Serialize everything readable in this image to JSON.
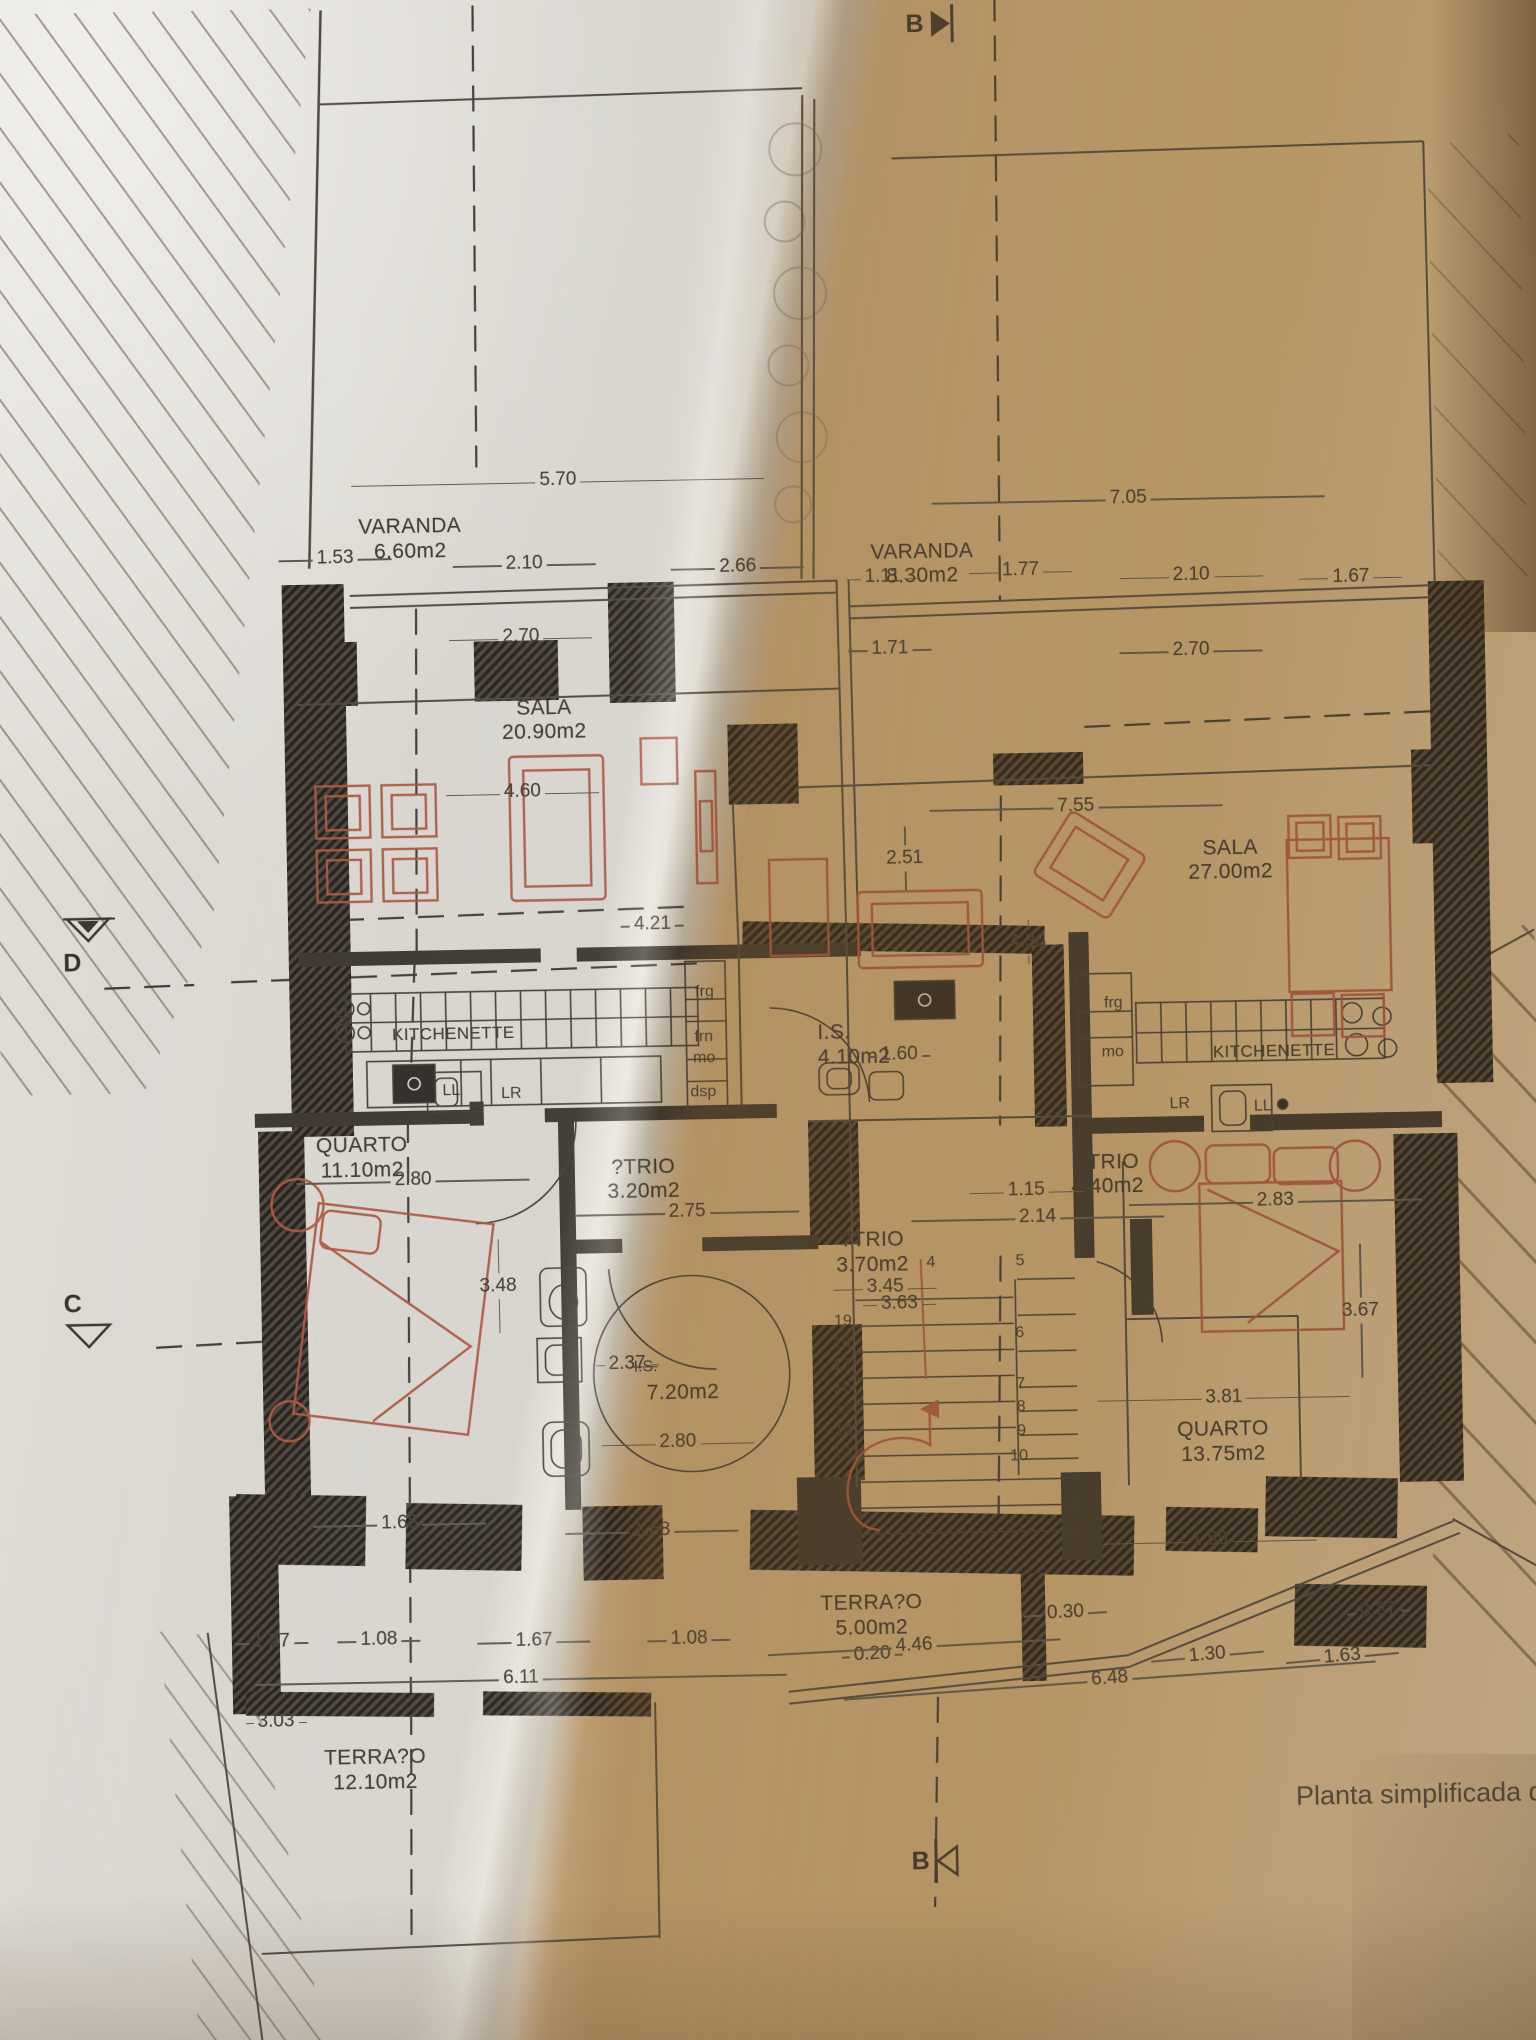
{
  "caption": "Planta simplificada de",
  "markers": {
    "b_top": "B",
    "b_bottom": "B",
    "c": "C",
    "d": "D"
  },
  "colors": {
    "paper_light": "#d9d5ce",
    "paper_shadow": "#c7a778",
    "ink": "#44403a",
    "wall": "#39342d",
    "furniture_red": "#a8553f",
    "dim_text": "#3f3a33"
  },
  "rooms": [
    {
      "id": "varanda-left",
      "name": "VARANDA",
      "area": "6.60m2",
      "x": 27.3,
      "y": 24.9
    },
    {
      "id": "varanda-right",
      "name": "VARANDA",
      "area": "8.30m2",
      "x": 60.6,
      "y": 26.6
    },
    {
      "id": "sala-left",
      "name": "SALA",
      "area": "20.90m2",
      "x": 35.8,
      "y": 33.9
    },
    {
      "id": "sala-right",
      "name": "SALA",
      "area": "27.00m2",
      "x": 80.3,
      "y": 41.4
    },
    {
      "id": "quarto-left",
      "name": "QUARTO",
      "area": "11.10m2",
      "x": 23.4,
      "y": 55.2
    },
    {
      "id": "quarto-right",
      "name": "QUARTO",
      "area": "13.75m2",
      "x": 79.1,
      "y": 69.9
    },
    {
      "id": "kitchenette-left",
      "name": "KITCHENETTE",
      "area": "",
      "x": 29.5,
      "y": 49.9,
      "small": true
    },
    {
      "id": "kitchenette-right",
      "name": "KITCHENETTE",
      "area": "",
      "x": 82.9,
      "y": 51.5,
      "small": true
    },
    {
      "id": "is-small",
      "name": "I.S.",
      "area": "4.10m2",
      "x": 53.2,
      "y": 50.1,
      "anchor": "left"
    },
    {
      "id": "atrio-left",
      "name": "?TRIO",
      "area": "3.20m2",
      "x": 41.7,
      "y": 56.5
    },
    {
      "id": "atrio-right",
      "name": "?TRIO",
      "area": "4.40m2",
      "x": 71.9,
      "y": 56.7
    },
    {
      "id": "atrio-mid",
      "name": "?TRIO",
      "area": "3.70m2",
      "x": 56.5,
      "y": 60.3
    },
    {
      "id": "is-big",
      "name": "",
      "area": "7.20m2",
      "x": 44.0,
      "y": 67.6
    },
    {
      "id": "terraco-small",
      "name": "TERRA?O",
      "area": "5.00m2",
      "x": 56.0,
      "y": 78.1
    },
    {
      "id": "terraco-big",
      "name": "TERRA?O",
      "area": "12.10m2",
      "x": 23.5,
      "y": 85.2
    }
  ],
  "appliances": [
    {
      "t": "frg",
      "x": 45.9,
      "y": 48.6
    },
    {
      "t": "frn",
      "x": 45.8,
      "y": 50.8
    },
    {
      "t": "mo",
      "x": 45.8,
      "y": 51.8
    },
    {
      "t": "dsp",
      "x": 45.7,
      "y": 53.5
    },
    {
      "t": "LL",
      "x": 29.3,
      "y": 53.2
    },
    {
      "t": "LR",
      "x": 33.2,
      "y": 53.4
    },
    {
      "t": "frg",
      "x": 72.5,
      "y": 49.5
    },
    {
      "t": "mo",
      "x": 72.4,
      "y": 51.9
    },
    {
      "t": "LR",
      "x": 76.7,
      "y": 54.5
    },
    {
      "t": "LL",
      "x": 82.1,
      "y": 54.7
    },
    {
      "t": "I.S.",
      "x": 41.6,
      "y": 66.9,
      "struck": true
    }
  ],
  "dimensions": [
    {
      "v_txt": "5.70",
      "x": 37.0,
      "y": 23.35,
      "w": 420
    },
    {
      "v_txt": "7.05",
      "x": 74.1,
      "y": 24.75,
      "w": 400
    },
    {
      "v_txt": "1.53",
      "x": 22.4,
      "y": 26.95,
      "w": 120
    },
    {
      "v_txt": "2.10",
      "x": 34.7,
      "y": 27.4,
      "w": 150
    },
    {
      "v_txt": "2.66",
      "x": 48.6,
      "y": 27.75,
      "w": 140
    },
    {
      "v_txt": "1.11",
      "x": 58.0,
      "y": 28.4,
      "w": 80
    },
    {
      "v_txt": "1.77",
      "x": 67.0,
      "y": 28.2,
      "w": 110
    },
    {
      "v_txt": "2.10",
      "x": 78.1,
      "y": 28.6,
      "w": 150
    },
    {
      "v_txt": "1.67",
      "x": 88.5,
      "y": 28.8,
      "w": 110
    },
    {
      "v_txt": "2.70",
      "x": 34.4,
      "y": 31.0,
      "w": 150
    },
    {
      "v_txt": "1.71",
      "x": 58.4,
      "y": 31.9,
      "w": 90
    },
    {
      "v_txt": "2.70",
      "x": 78.0,
      "y": 32.25,
      "w": 150
    },
    {
      "v_txt": "4.60",
      "x": 34.3,
      "y": 38.6,
      "w": 160
    },
    {
      "v_txt": "2.51",
      "x": 59.1,
      "y": 42.2,
      "w": 90,
      "vert": true
    },
    {
      "v_txt": "7.55",
      "x": 70.3,
      "y": 39.8,
      "w": 300
    },
    {
      "v_txt": "4.21",
      "x": 42.6,
      "y": 45.2,
      "w": 70
    },
    {
      "v_txt": "4.36",
      "x": 67.0,
      "y": 46.4,
      "w": 70,
      "vert": true
    },
    {
      "v_txt": "2.80",
      "x": 26.7,
      "y": 57.5,
      "w": 240
    },
    {
      "v_txt": "2.75",
      "x": 44.5,
      "y": 59.3,
      "w": 230
    },
    {
      "v_txt": "1.15",
      "x": 66.6,
      "y": 58.6,
      "w": 120
    },
    {
      "v_txt": "2.14",
      "x": 67.3,
      "y": 59.9,
      "w": 260
    },
    {
      "v_txt": "2.83",
      "x": 82.8,
      "y": 59.3,
      "w": 300
    },
    {
      "v_txt": "3.48",
      "x": 32.1,
      "y": 62.8,
      "w": 120,
      "vert": true
    },
    {
      "v_txt": "3.45",
      "x": 57.3,
      "y": 63.2,
      "w": 110
    },
    {
      "v_txt": "3.63",
      "x": 58.2,
      "y": 64.0,
      "w": 80
    },
    {
      "v_txt": "2.37",
      "x": 40.4,
      "y": 66.7,
      "w": 70
    },
    {
      "v_txt": "3.67",
      "x": 88.2,
      "y": 64.8,
      "w": 160,
      "vert": true
    },
    {
      "v_txt": "2.80",
      "x": 43.6,
      "y": 70.6,
      "w": 160
    },
    {
      "v_txt": "3.81",
      "x": 79.2,
      "y": 68.9,
      "w": 260
    },
    {
      "v_txt": "1.89",
      "x": 78.1,
      "y": 75.9,
      "w": 220
    },
    {
      "v_txt": "1.68",
      "x": 25.4,
      "y": 74.3,
      "w": 180
    },
    {
      "v_txt": "1.68",
      "x": 41.8,
      "y": 74.9,
      "w": 180
    },
    {
      "v_txt": "1.27",
      "x": 16.9,
      "y": 80.0,
      "w": 80
    },
    {
      "v_txt": "1.08",
      "x": 23.9,
      "y": 80.0,
      "w": 90
    },
    {
      "v_txt": "1.67",
      "x": 34.0,
      "y": 80.2,
      "w": 120
    },
    {
      "v_txt": "1.08",
      "x": 44.1,
      "y": 80.25,
      "w": 90
    },
    {
      "v_txt": "6.11",
      "x": 33.1,
      "y": 82.0,
      "w": 540
    },
    {
      "v_txt": "0.20",
      "x": 56.0,
      "y": 81.2,
      "w": 60,
      "rot": -2
    },
    {
      "v_txt": "4.46",
      "x": 58.7,
      "y": 80.8,
      "w": 300,
      "rot": -2
    },
    {
      "v_txt": "0.30",
      "x": 68.6,
      "y": 79.3,
      "w": 90,
      "rot": -2
    },
    {
      "v_txt": "0.37",
      "x": 89.0,
      "y": 79.5,
      "w": 70,
      "rot": -3
    },
    {
      "v_txt": "1.30",
      "x": 77.8,
      "y": 81.5,
      "w": 120,
      "rot": -4
    },
    {
      "v_txt": "1.63",
      "x": 86.6,
      "y": 81.7,
      "w": 120,
      "rot": -4
    },
    {
      "v_txt": "6.48",
      "x": 71.4,
      "y": 82.6,
      "w": 540,
      "rot": -3
    },
    {
      "v_txt": "3.03",
      "x": 17.1,
      "y": 83.9,
      "w": 60
    },
    {
      "v_txt": "1.60",
      "x": 58.5,
      "y": 51.8,
      "w": 46
    }
  ],
  "stair_numbers": [
    {
      "t": "19",
      "x": 54.5,
      "y": 64.85
    },
    {
      "t": "18",
      "x": 54.4,
      "y": 65.95
    },
    {
      "t": "17",
      "x": 54.4,
      "y": 67.0
    },
    {
      "t": "16",
      "x": 54.4,
      "y": 68.1
    },
    {
      "t": "15",
      "x": 54.4,
      "y": 69.15
    },
    {
      "t": "14",
      "x": 54.4,
      "y": 70.25
    },
    {
      "t": "13",
      "x": 54.3,
      "y": 71.3
    },
    {
      "t": "4",
      "x": 60.3,
      "y": 62.05
    },
    {
      "t": "5",
      "x": 66.1,
      "y": 62.05
    },
    {
      "t": "6",
      "x": 66.0,
      "y": 65.6
    },
    {
      "t": "7",
      "x": 66.0,
      "y": 68.1
    },
    {
      "t": "8",
      "x": 66.0,
      "y": 69.2
    },
    {
      "t": "9",
      "x": 66.0,
      "y": 70.4
    },
    {
      "t": "10",
      "x": 65.8,
      "y": 71.6
    }
  ]
}
